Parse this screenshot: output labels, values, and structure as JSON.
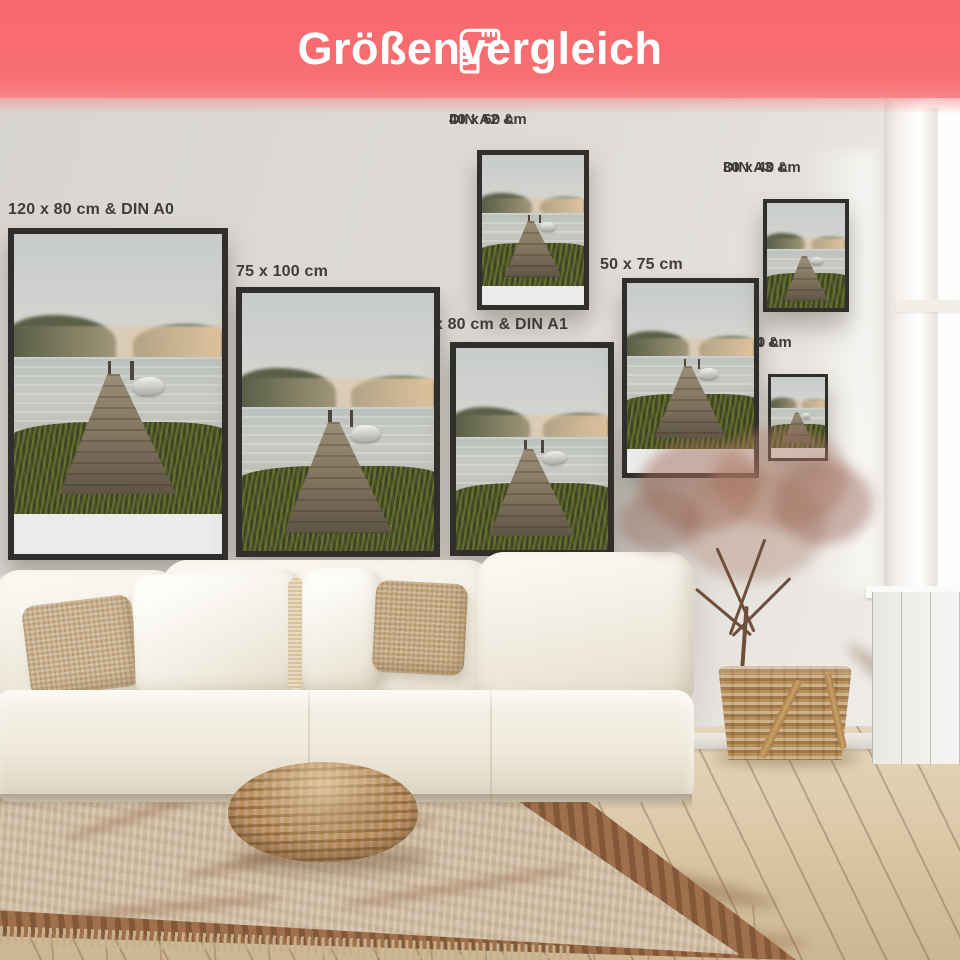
{
  "header": {
    "title": "Größenvergleich",
    "icon": "ruler-icon",
    "background_color": "#f8696d",
    "text_color": "#ffffff"
  },
  "size_labels": [
    {
      "id": "din-a0",
      "line1": "120 x 80 cm & DIN A0"
    },
    {
      "id": "75x100",
      "line1": "75 x 100 cm"
    },
    {
      "id": "din-a2",
      "line1": "DIN A2 &",
      "line2": "40 x 60 cm"
    },
    {
      "id": "din-a1",
      "line1": "60 x 80 cm & DIN A1"
    },
    {
      "id": "50x75",
      "line1": "50 x 75 cm"
    },
    {
      "id": "din-a3",
      "line1": "DIN A3 &",
      "line2": "30 x 40 cm"
    },
    {
      "id": "din-a4",
      "line1": "DIN A4 &",
      "line2": "20 x 30 cm"
    }
  ],
  "scene": {
    "poster_motif": "misty lake with wooden jetty and rowboat",
    "frame_color": "#302f2d",
    "wall_color": "#dedbd6",
    "label_text_color": "#3e3d3a"
  }
}
